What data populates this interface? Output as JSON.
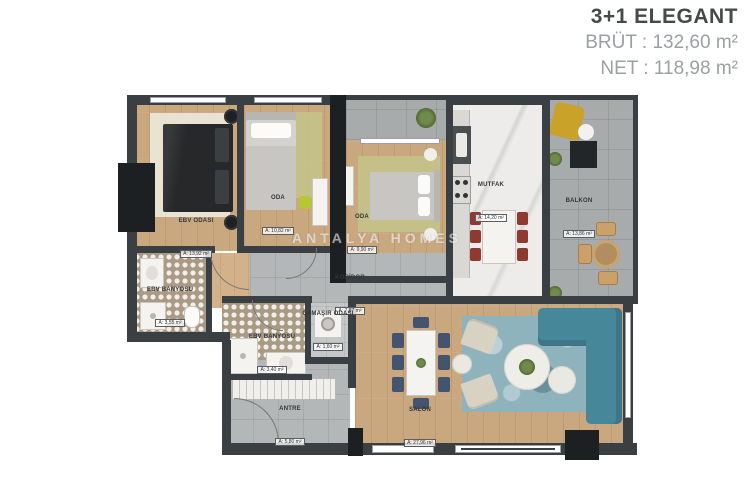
{
  "title": {
    "name": "3+1 ELEGANT",
    "brut": "BRÜT : 132,60 m²",
    "net": "NET : 118,98 m²"
  },
  "watermark": "ANTALYA HOMES",
  "colors": {
    "wall": "#3a3f43",
    "wood_floor": "#c9a87f",
    "gray_tile": "#b4b7b8",
    "balcony_tile": "#a7abac",
    "marble": "#edecea",
    "bath_tile": "#a89a85",
    "sofa_teal": "#47879a",
    "chair_navy": "#44536e",
    "chair_red": "#8e3a33",
    "accent_mustard": "#c9a22a",
    "rug_blue": "#8fb3bd",
    "rug_green": "#c3c489",
    "rug_cream": "#e9e3d3",
    "title_dark": "#46494c",
    "title_gray": "#9ba0a3"
  },
  "rooms": [
    {
      "id": "ebv-odasi",
      "label": "EBV ODASI",
      "area": "A: 13,92 m²"
    },
    {
      "id": "oda-1",
      "label": "ODA",
      "area": "A: 10,82 m²"
    },
    {
      "id": "oda-2",
      "label": "ODA",
      "area": "A: 9,90 m²"
    },
    {
      "id": "mutfak",
      "label": "MUTFAK",
      "area": "A: 14,20 m²"
    },
    {
      "id": "balkon",
      "label": "BALKON",
      "area": "A: 13,86 m²"
    },
    {
      "id": "koridor",
      "label": "KORİDOR",
      "area": "A: 7,87 m²"
    },
    {
      "id": "ebv-banyosu",
      "label": "EBV BANYOSU",
      "area": "A: 3,55 m²"
    },
    {
      "id": "banyo",
      "label": "EBV BANYOSU",
      "area": "A: 3,40 m²"
    },
    {
      "id": "camasir-odasi",
      "label": "ÇAMAŞIR ODASI",
      "area": "A: 1,60 m²"
    },
    {
      "id": "antre",
      "label": "ANTRE",
      "area": "A: 5,80 m²"
    },
    {
      "id": "salon",
      "label": "SALON",
      "area": "A: 27,96 m²"
    }
  ]
}
